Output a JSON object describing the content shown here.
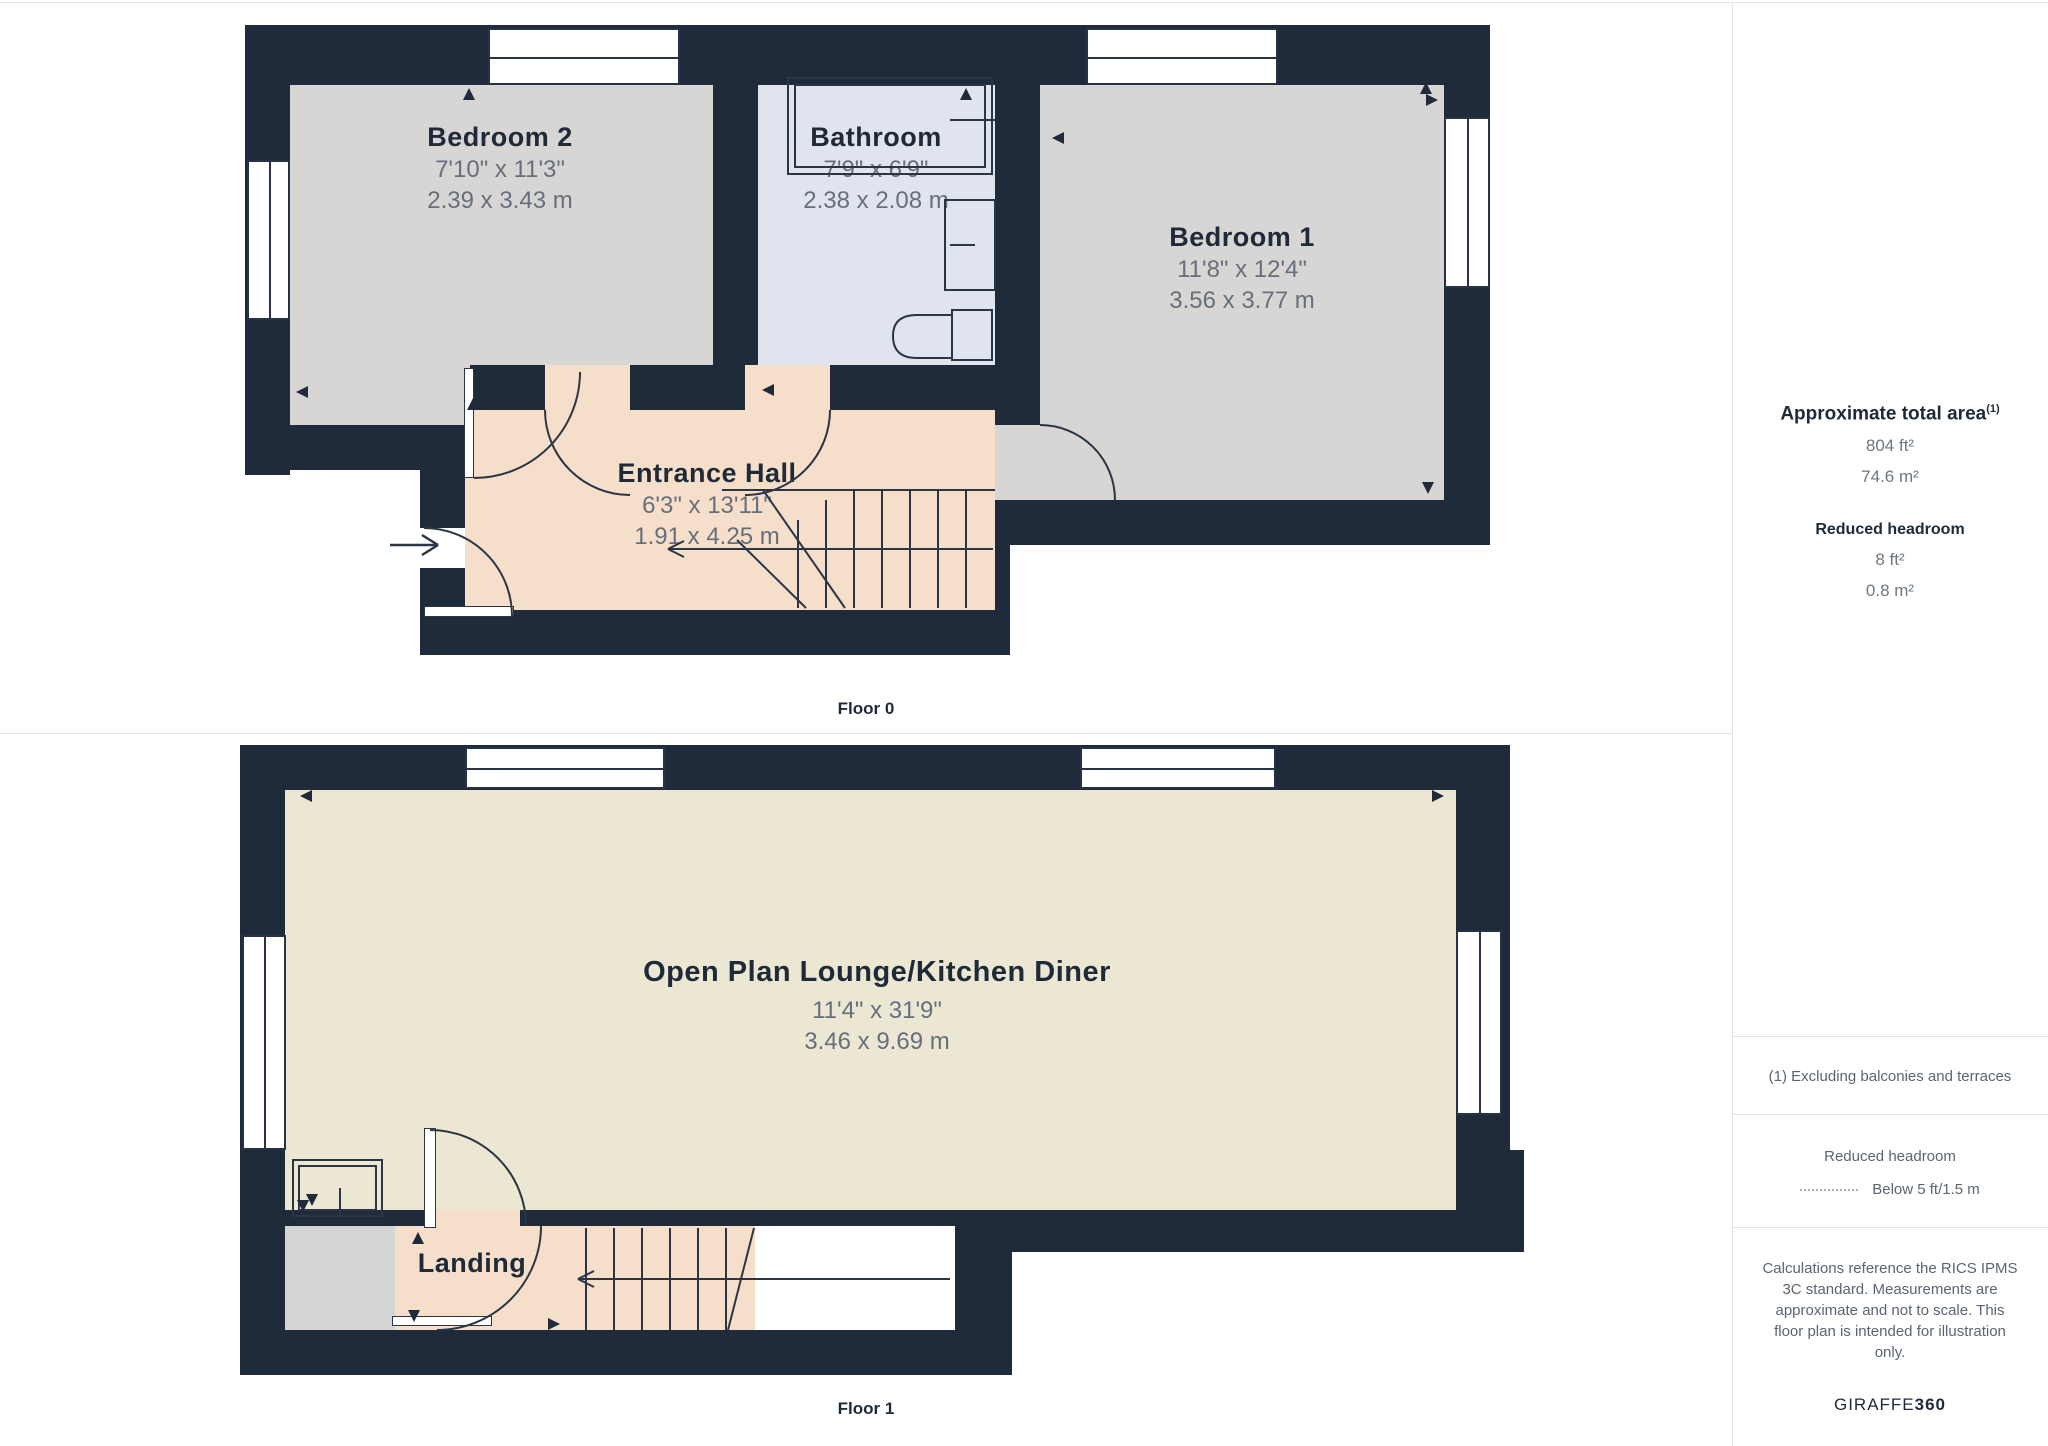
{
  "floor0_label": "Floor 0",
  "floor1_label": "Floor 1",
  "rooms": {
    "bedroom2": {
      "name": "Bedroom 2",
      "imperial": "7'10\" x 11'3\"",
      "metric": "2.39 x 3.43 m"
    },
    "bathroom": {
      "name": "Bathroom",
      "imperial": "7'9\" x 6'9\"",
      "metric": "2.38 x 2.08 m"
    },
    "bedroom1": {
      "name": "Bedroom 1",
      "imperial": "11'8\" x 12'4\"",
      "metric": "3.56 x 3.77 m"
    },
    "entrance_hall": {
      "name": "Entrance Hall",
      "imperial": "6'3\" x 13'11\"",
      "metric": "1.91 x 4.25 m"
    },
    "lounge": {
      "name": "Open Plan Lounge/Kitchen Diner",
      "imperial": "11'4\" x 31'9\"",
      "metric": "3.46 x 9.69 m"
    },
    "landing": {
      "name": "Landing"
    }
  },
  "sidebar": {
    "total_area_title": "Approximate total area",
    "total_area_sup": "(1)",
    "total_area_ft": "804 ft²",
    "total_area_m": "74.6 m²",
    "reduced_headroom_title": "Reduced headroom",
    "reduced_headroom_ft": "8 ft²",
    "reduced_headroom_m": "0.8 m²",
    "footnote": "(1) Excluding balconies and terraces",
    "legend_title": "Reduced headroom",
    "legend_value": "Below 5 ft/1.5 m",
    "disclaimer": "Calculations reference the RICS IPMS 3C standard. Measurements are approximate and not to scale. This floor plan is intended for illustration only.",
    "brand_regular": "GIRAFFE",
    "brand_bold": "360"
  },
  "colors": {
    "wall": "#1f2b3a",
    "bedroom_floor": "#d7d6d4",
    "bathroom_floor": "#e0e4ef",
    "hall_floor": "#f6dfca",
    "lounge_floor": "#ece7d3",
    "reduced_headroom_area": "#d4d4d4",
    "line": "#2b3544",
    "dim_text": "#666f7b",
    "name_text": "#1f2a38"
  }
}
